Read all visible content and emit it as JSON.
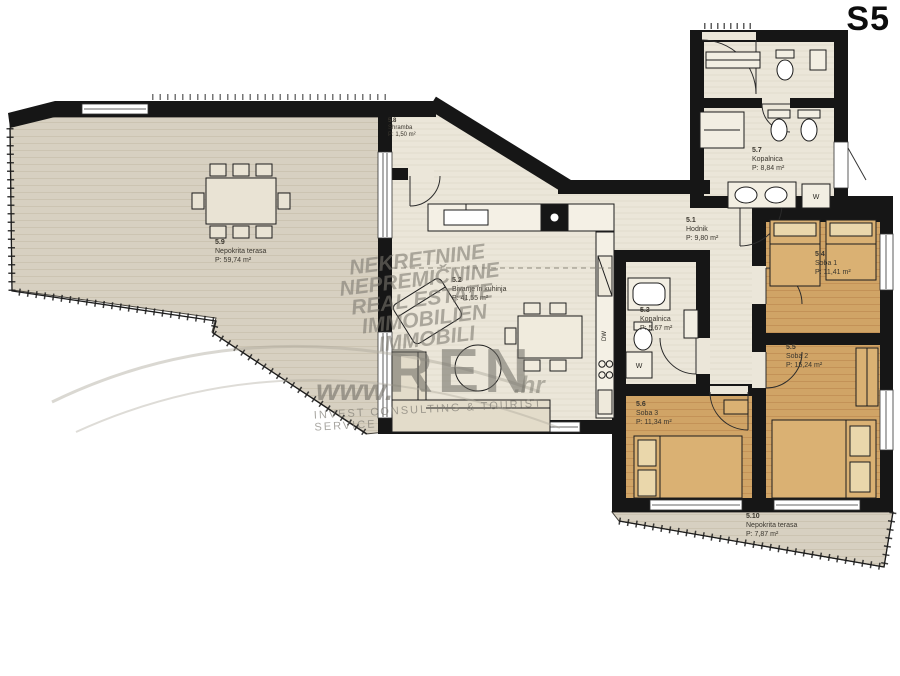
{
  "title": "S5",
  "rooms": [
    {
      "id": "5.1",
      "name": "Hodnik",
      "area": "P: 9,80 m²"
    },
    {
      "id": "5.2",
      "name": "Bivanje in kuhinja",
      "area": "P: 41,55 m²"
    },
    {
      "id": "5.3",
      "name": "Kopalnica",
      "area": "P: 5,67 m²"
    },
    {
      "id": "5.4",
      "name": "Soba 1",
      "area": "P: 11,41 m²"
    },
    {
      "id": "5.5",
      "name": "Soba 2",
      "area": "P: 15,24 m²"
    },
    {
      "id": "5.6",
      "name": "Soba 3",
      "area": "P: 11,34 m²"
    },
    {
      "id": "5.7",
      "name": "Kopalnica",
      "area": "P: 8,84 m²"
    },
    {
      "id": "5.8",
      "name": "Shramba",
      "area": "P: 1,50 m²"
    },
    {
      "id": "5.9",
      "name": "Nepokrita terasa",
      "area": "P:  59,74 m²"
    },
    {
      "id": "5.10",
      "name": "Nepokrita terasa",
      "area": "P:  7,87 m²"
    }
  ],
  "appliances": {
    "washer_main_bath": "W",
    "washer_small_bath": "W",
    "dishwasher": "DW"
  },
  "watermark": {
    "line1": "NEKRETNINE",
    "line2": "NEPREMIČNINE",
    "line3": "REAL ESTATE",
    "line4": "IMMOBILIEN",
    "line5": "IMMOBILI",
    "www": "www.",
    "brand": "REN",
    "tld": ".hr",
    "tagline": "INVEST CONSULTING & TOURIST SERVICE"
  },
  "colors": {
    "wall": "#161616",
    "terrace": "#d7d0c1",
    "interior": "#ebe6d9",
    "wood": "#d0a466"
  }
}
